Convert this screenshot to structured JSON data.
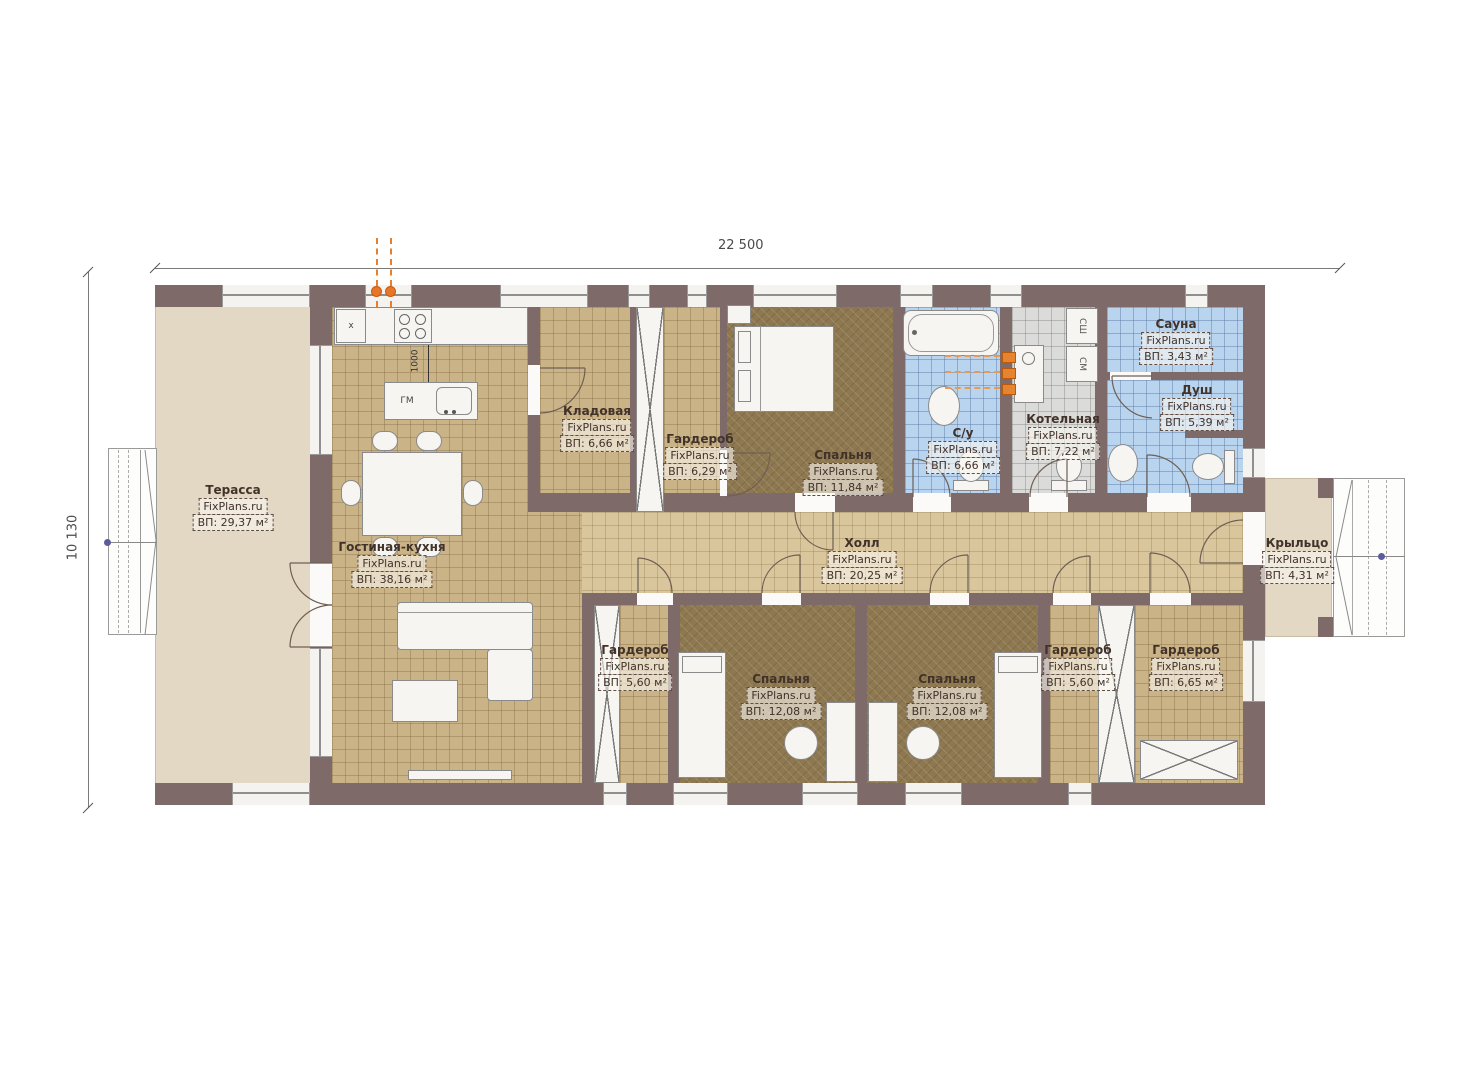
{
  "watermark": "FixPlans.ru",
  "dimensions": {
    "overall_width": "22 500",
    "overall_height": "10 130",
    "kitchen_island_gap": "1000"
  },
  "appliances": {
    "kitchen_hood": "x",
    "island_dishwasher": "ГМ",
    "dryer": "СШ",
    "washer": "СМ"
  },
  "rooms": [
    {
      "id": "terrace",
      "name": "Терасса",
      "area": "ВП: 29,37 м²"
    },
    {
      "id": "living-kitchen",
      "name": "Гостиная-кухня",
      "area": "ВП: 38,16 м²"
    },
    {
      "id": "storage",
      "name": "Кладовая",
      "area": "ВП: 6,66 м²"
    },
    {
      "id": "wardrobe-top",
      "name": "Гардероб",
      "area": "ВП: 6,29 м²"
    },
    {
      "id": "bedroom-master",
      "name": "Спальня",
      "area": "ВП: 11,84 м²"
    },
    {
      "id": "bathroom",
      "name": "С/у",
      "area": "ВП: 6,66 м²"
    },
    {
      "id": "boiler-room",
      "name": "Котельная",
      "area": "ВП: 7,22 м²"
    },
    {
      "id": "sauna",
      "name": "Сауна",
      "area": "ВП: 3,43 м²"
    },
    {
      "id": "shower",
      "name": "Душ",
      "area": "ВП: 5,39 м²"
    },
    {
      "id": "hall",
      "name": "Холл",
      "area": "ВП: 20,25 м²"
    },
    {
      "id": "wardrobe-bl",
      "name": "Гардероб",
      "area": "ВП: 5,60 м²"
    },
    {
      "id": "bedroom-1",
      "name": "Спальня",
      "area": "ВП: 12,08 м²"
    },
    {
      "id": "bedroom-2",
      "name": "Спальня",
      "area": "ВП: 12,08 м²"
    },
    {
      "id": "wardrobe-br1",
      "name": "Гардероб",
      "area": "ВП: 5,60 м²"
    },
    {
      "id": "wardrobe-br2",
      "name": "Гардероб",
      "area": "ВП: 6,65 м²"
    },
    {
      "id": "porch",
      "name": "Крыльцо",
      "area": "ВП: 4,31 м²"
    }
  ],
  "colors": {
    "wall": "#7d6a69",
    "floor_tile_tan": "#cbb388",
    "floor_hall": "#d9c69c",
    "floor_bedroom": "#8e7850",
    "floor_wet_blue": "#b9d4ee",
    "floor_boiler_gray": "#dbdbd9",
    "terrace_beige": "#e3d8c3",
    "accent_orange": "#e8762a"
  }
}
